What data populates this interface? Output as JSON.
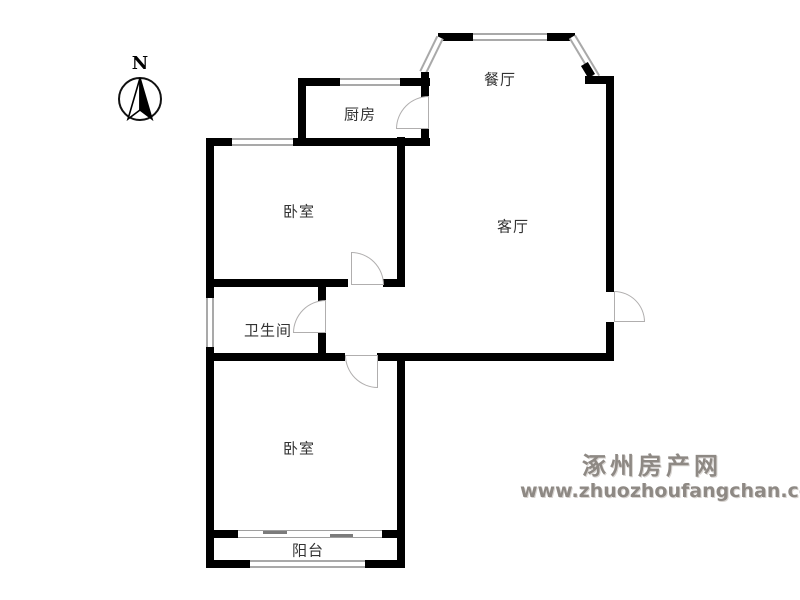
{
  "compass": {
    "label": "N"
  },
  "rooms": {
    "kitchen": {
      "label": "厨房"
    },
    "dining": {
      "label": "餐厅"
    },
    "bedroom_top": {
      "label": "卧室"
    },
    "bathroom": {
      "label": "卫生间"
    },
    "living": {
      "label": "客厅"
    },
    "bedroom_bottom": {
      "label": "卧室"
    },
    "balcony": {
      "label": "阳台"
    }
  },
  "watermark": {
    "site_name": "涿州房产网",
    "site_url": "www.zhuozhoufangchan.com",
    "color": "#8e8984"
  },
  "colors": {
    "wall": "#000000",
    "window_line": "#a9a9a9",
    "door_arc": "#b0aeae",
    "label_text": "#333333",
    "background": "#ffffff"
  }
}
